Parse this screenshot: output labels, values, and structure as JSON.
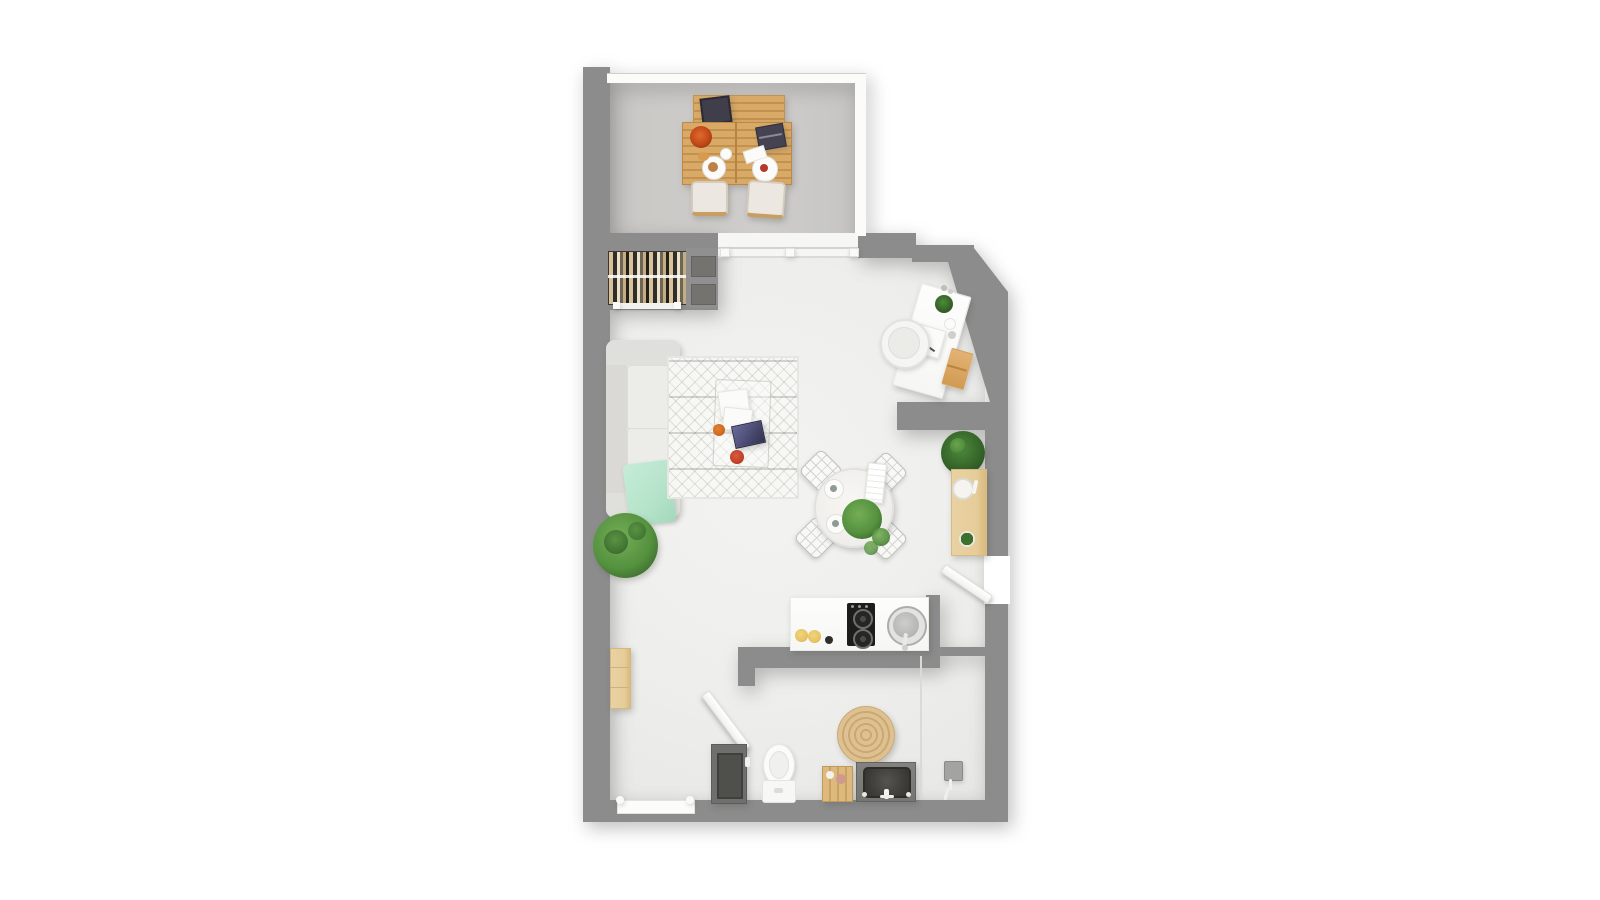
{
  "meta": {
    "aria_label": "Top-down 3D rendered floor plan of a studio apartment with balcony, living room, desk nook, kitchenette and bathroom",
    "visible_text": "none"
  },
  "colors": {
    "wall": "#8c8c8c",
    "balcony_floor": "#cac9c6",
    "floor": "#eeeeec",
    "rug": "#f7f7f4",
    "wood": "#d9a967",
    "wood_light": "#e6cd9a",
    "mint": "#b5e3c9",
    "green": "#55923f",
    "green_dark": "#36602a",
    "jute": "#d9bc8c",
    "vanity": "#757572",
    "cooktop": "#1d1d1c"
  },
  "rooms": [
    "balcony",
    "living-room",
    "desk-nook",
    "dining-area",
    "hallway",
    "kitchenette",
    "bathroom"
  ],
  "items": [
    "outdoor-bench",
    "outdoor-dining-table",
    "outdoor-chair",
    "tablet",
    "laptop",
    "wardrobe-clothes-rail",
    "wardrobe-shelves",
    "sliding-balcony-door",
    "sofa",
    "mint-throw-blanket",
    "berber-rug",
    "acrylic-coffee-table",
    "magazines",
    "potted-plant",
    "round-dining-table",
    "wire-dining-chair",
    "napkin-stack",
    "desk",
    "desk-chair",
    "desk-drawer-unit",
    "console-table",
    "entry-door",
    "kitchen-counter",
    "induction-cooktop",
    "kitchen-sink",
    "lemons",
    "bathroom-door",
    "bathroom-cabinet",
    "toilet",
    "storage-crate",
    "jute-rug",
    "vanity-sink",
    "shower-mixer",
    "glass-partition",
    "wall-shelf",
    "window"
  ]
}
